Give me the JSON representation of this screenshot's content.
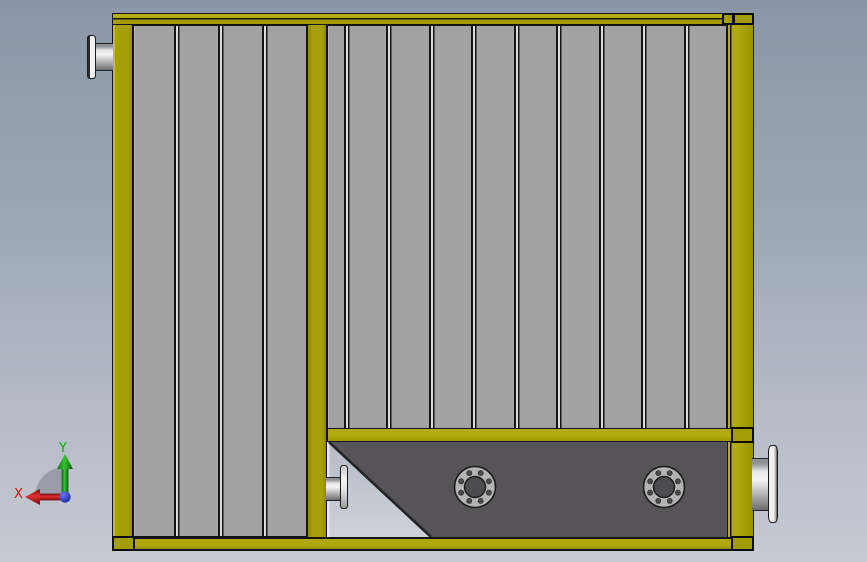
{
  "viewport": {
    "label": "3D CAD viewport - side view of panel-wall boiler assembly with hopper",
    "background_top_color": "#8a96a8",
    "background_bottom_color": "#c6cad3"
  },
  "triad": {
    "x_label": "X",
    "y_label": "Y",
    "x_color": "#d01010",
    "y_color": "#00b000",
    "origin_color": "#2a3ac0"
  },
  "model": {
    "outline_color": "#141414",
    "frame_color": "#a49c04",
    "panel_color": "#a2a2a2",
    "hopper_plate_color": "#575457",
    "left_wall": {
      "panel_count": 4
    },
    "right_wall": {
      "panel_count": 10
    },
    "hopper": {
      "flange_count": 2,
      "flange_bolt_holes": 8
    },
    "nozzle_count": 3
  }
}
